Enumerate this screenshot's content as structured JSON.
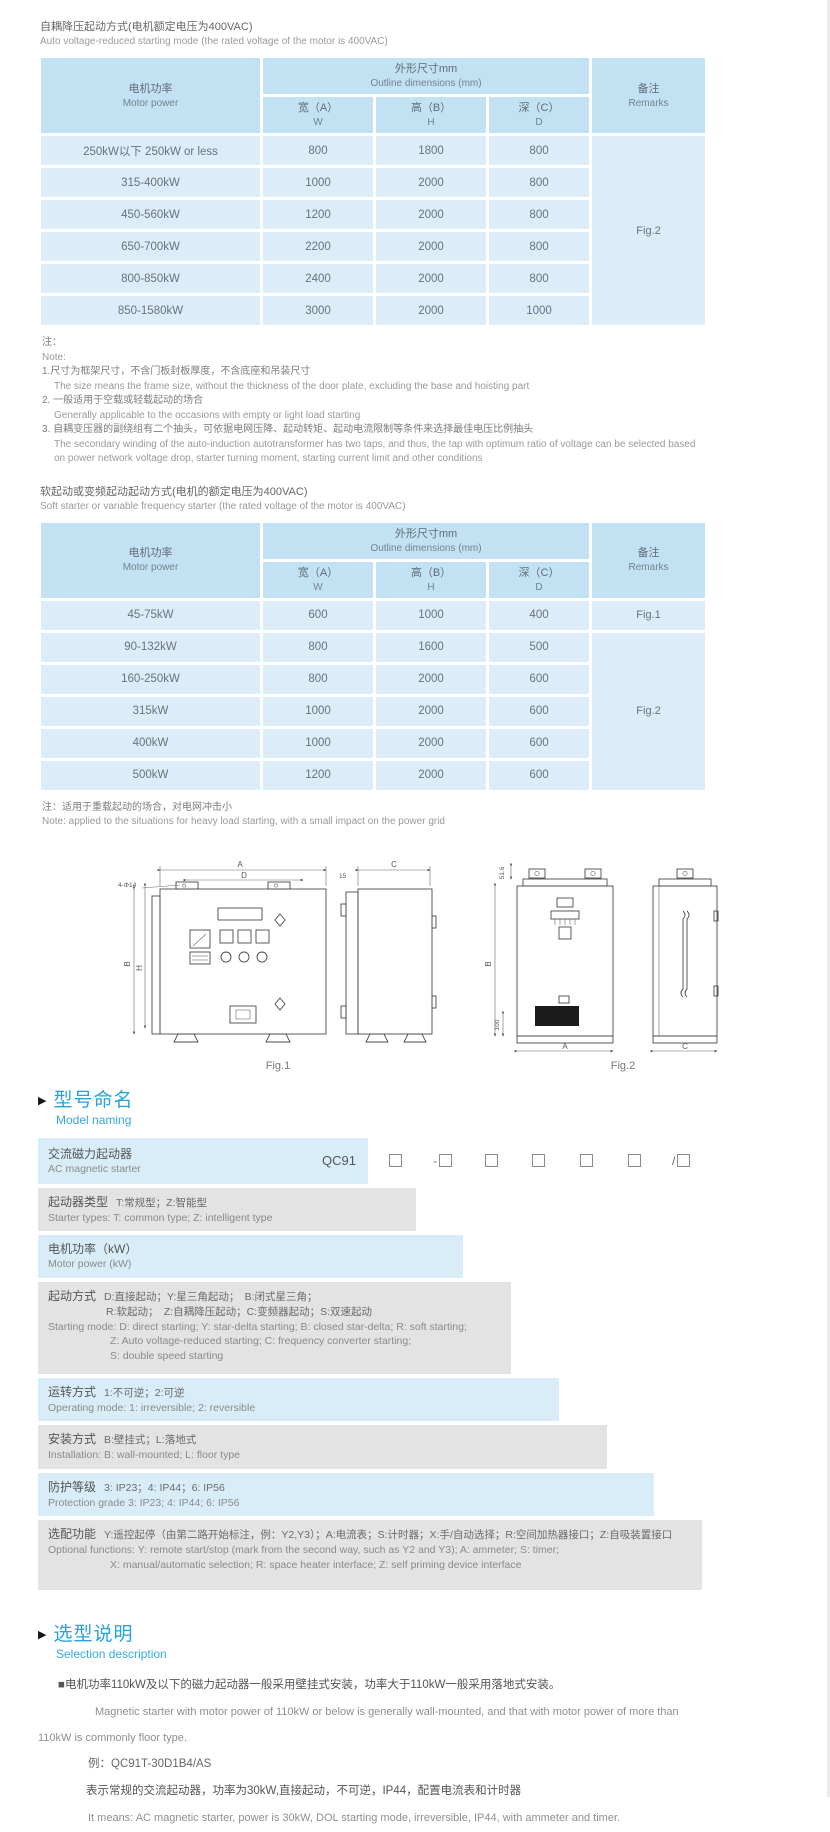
{
  "colors": {
    "table_header_bg": "#c2e2f4",
    "table_row_bg": "#dcedf9",
    "stripe_grey": "#e3e3e3",
    "stripe_blue": "#d9edf9",
    "heading_blue": "#25a3dc",
    "text_grey": "#666666"
  },
  "s1": {
    "title_zh": "自耦降压起动方式(电机额定电压为400VAC)",
    "title_en": "Auto voltage-reduced starting mode (the rated voltage of the motor is 400VAC)"
  },
  "t1": {
    "h": {
      "power_zh": "电机功率",
      "power_en": "Motor power",
      "dims_zh": "外形尺寸mm",
      "dims_en": "Outline dimensions (mm)",
      "remarks_zh": "备注",
      "remarks_en": "Remarks",
      "w_zh": "宽（A）",
      "w_en": "W",
      "h_zh": "高（B）",
      "h_en": "H",
      "d_zh": "深（C）",
      "d_en": "D"
    },
    "rows": [
      {
        "power": "250kW以下 250kW or less",
        "w": "800",
        "h": "1800",
        "d": "800"
      },
      {
        "power": "315-400kW",
        "w": "1000",
        "h": "2000",
        "d": "800"
      },
      {
        "power": "450-560kW",
        "w": "1200",
        "h": "2000",
        "d": "800"
      },
      {
        "power": "650-700kW",
        "w": "2200",
        "h": "2000",
        "d": "800"
      },
      {
        "power": "800-850kW",
        "w": "2400",
        "h": "2000",
        "d": "800"
      },
      {
        "power": "850-1580kW",
        "w": "3000",
        "h": "2000",
        "d": "1000"
      }
    ],
    "remark": "Fig.2"
  },
  "note1": {
    "label_zh": "注：",
    "label_en": "Note:",
    "items": [
      {
        "zh": "1.尺寸为框架尺寸，不含门板封板厚度，不含底座和吊装尺寸",
        "en": "The size means the frame size, without the thickness of the door plate, excluding the base and hoisting part"
      },
      {
        "zh": "2. 一般适用于空载或轻载起动的场合",
        "en": "Generally applicable to the occasions with empty or light load starting"
      },
      {
        "zh": "3. 自耦变压器的副绕组有二个抽头，可依据电网压降、起动转矩、起动电流限制等条件来选择最佳电压比例抽头",
        "en": "The secondary winding of the auto-induction autotransformer has two taps, and thus, the tap with optimum ratio of voltage can be selected based on power network voltage drop, starter turning moment, starting current limit and other conditions"
      }
    ]
  },
  "s2": {
    "title_zh": "软起动或变频起动起动方式(电机的额定电压为400VAC)",
    "title_en": "Soft starter or variable frequency starter (the rated voltage of the motor is 400VAC)"
  },
  "t2": {
    "h": {
      "power_zh": "电机功率",
      "power_en": "Motor power",
      "dims_zh": "外形尺寸mm",
      "dims_en": "Outline dimensions (mm)",
      "remarks_zh": "备注",
      "remarks_en": "Remarks",
      "w_zh": "宽（A）",
      "w_en": "W",
      "h_zh": "高（B）",
      "h_en": "H",
      "d_zh": "深（C）",
      "d_en": "D"
    },
    "rows": [
      {
        "power": "45-75kW",
        "w": "600",
        "h": "1000",
        "d": "400"
      },
      {
        "power": "90-132kW",
        "w": "800",
        "h": "1600",
        "d": "500"
      },
      {
        "power": "160-250kW",
        "w": "800",
        "h": "2000",
        "d": "600"
      },
      {
        "power": "315kW",
        "w": "1000",
        "h": "2000",
        "d": "600"
      },
      {
        "power": "400kW",
        "w": "1000",
        "h": "2000",
        "d": "600"
      },
      {
        "power": "500kW",
        "w": "1200",
        "h": "2000",
        "d": "600"
      }
    ],
    "remark_row1": "Fig.1",
    "remark_span": "Fig.2"
  },
  "note2": {
    "zh": "注：适用于重载起动的场合，对电网冲击小",
    "en": "Note: applied to the situations for heavy load starting, with a small impact on the power grid"
  },
  "figures": {
    "fig1": {
      "caption": "Fig.1",
      "labels": {
        "a": "A",
        "d": "D",
        "holes": "4-Φ14",
        "b": "B",
        "h": "H",
        "c": "C",
        "offset": "15"
      }
    },
    "fig2": {
      "caption": "Fig.2",
      "labels": {
        "top": "51.6",
        "b": "B",
        "bottom": "100",
        "a": "A",
        "c": "C"
      }
    }
  },
  "mn": {
    "heading_zh": "型号命名",
    "heading_en": "Model naming",
    "base_zh": "交流磁力起动器",
    "base_en": "AC magnetic starter",
    "code": "QC91",
    "positions": [
      {
        "prefix": ""
      },
      {
        "prefix": "-"
      },
      {
        "prefix": ""
      },
      {
        "prefix": ""
      },
      {
        "prefix": ""
      },
      {
        "prefix": ""
      },
      {
        "prefix": "/"
      }
    ],
    "rows": [
      {
        "t": "起动器类型",
        "d": "T:常规型；Z:智能型",
        "en": "Starter types: T: common type; Z: intelligent type"
      },
      {
        "t": "电机功率（kW）",
        "d": "",
        "en": "Motor power (kW)"
      },
      {
        "t": "起动方式",
        "d": "D:直接起动；Y:星三角起动；　B:闭式星三角；",
        "d2": "R:软起动；　Z:自耦降压起动；C:变频器起动；S:双速起动",
        "en": "Starting mode: D: direct starting; Y: star-delta starting; B: closed star-delta; R: soft starting;",
        "en2": "Z: Auto voltage-reduced starting; C: frequency converter starting;",
        "en3": "S: double speed starting"
      },
      {
        "t": "运转方式",
        "d": "1:不可逆；2:可逆",
        "en": "Operating mode: 1: irreversible; 2: reversible"
      },
      {
        "t": "安装方式",
        "d": "B:壁挂式；L:落地式",
        "en": "Installation: B: wall-mounted;  L: floor type"
      },
      {
        "t": "防护等级",
        "d": "3: IP23；4: IP44；6: IP56",
        "en": "Protection grade  3: IP23;  4: IP44;  6: IP56"
      },
      {
        "t": "选配功能",
        "d": "Y:遥控起停（由第二路开始标注，例：Y2,Y3）；A:电流表；S:计时器；X:手/自动选择；R:空间加热器接口；Z:自吸装置接口",
        "en": "Optional functions: Y: remote start/stop (mark from the second way, such as Y2 and Y3); A: ammeter; S: timer;",
        "en2": "X: manual/automatic selection; R: space heater interface; Z: self priming device interface"
      }
    ]
  },
  "sel": {
    "heading_zh": "选型说明",
    "heading_en": "Selection description",
    "p1_zh": "■电机功率110kW及以下的磁力起动器一般采用壁挂式安装，功率大于110kW一般采用落地式安装。",
    "p1_en": "Magnetic starter with motor power of 110kW or below is generally wall-mounted, and that with motor power of more than 110kW is commonly floor type.",
    "ex": "例：QC91T-30D1B4/AS",
    "ex_zh": "表示常规的交流起动器，功率为30kW,直接起动，不可逆，IP44，配置电流表和计时器",
    "ex_en": "It means: AC magnetic starter, power is 30kW, DOL starting mode, irreversible, IP44, with ammeter and timer."
  }
}
